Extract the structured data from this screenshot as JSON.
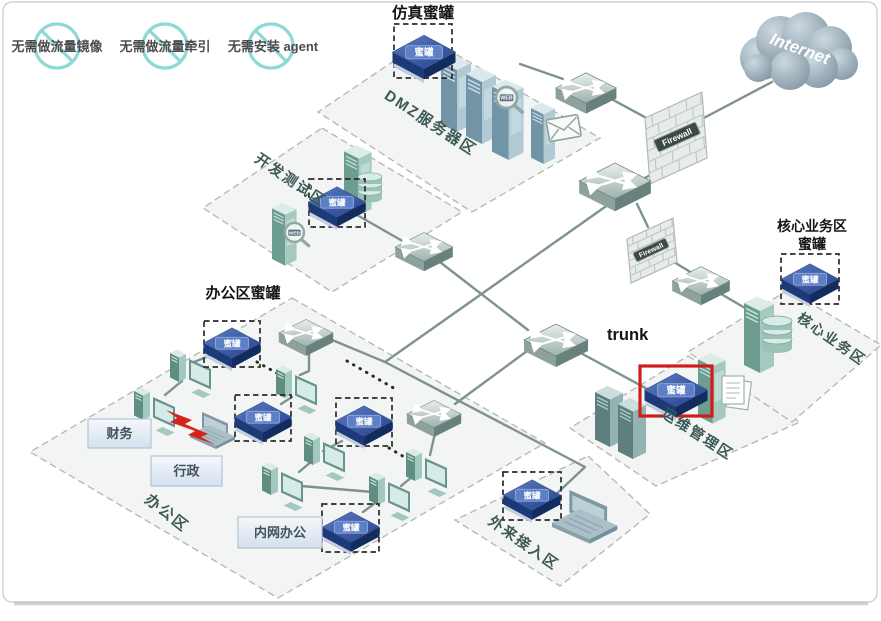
{
  "titles": {
    "simulation_honeypot": "仿真蜜罐",
    "office_honeypot": "办公区蜜罐",
    "core_honeypot_line1": "核心业务区",
    "core_honeypot_line2": "蜜罐",
    "trunk": "trunk",
    "internet": "Internet"
  },
  "restrictions": [
    "无需做流量镜像",
    "无需做流量牵引",
    "无需安装 agent"
  ],
  "zones": [
    {
      "id": "dmz",
      "label": "DMZ服务器区"
    },
    {
      "id": "dev",
      "label": "开发测试区"
    },
    {
      "id": "office",
      "label": "办公区"
    },
    {
      "id": "ops",
      "label": "运维管理区"
    },
    {
      "id": "core",
      "label": "核心业务区"
    },
    {
      "id": "external",
      "label": "外来接入区"
    }
  ],
  "office_groups": [
    "财务",
    "行政",
    "内网办公"
  ],
  "devices": {
    "honeypot_label": "蜜罐",
    "firewall_label": "Firewall",
    "web_label": "WEB"
  },
  "colors": {
    "trunk": "#e87c25",
    "honeypot_blue": "#2c4a8e",
    "highlight_red": "#cf1d1d",
    "link": "#7e938d",
    "restriction_circle": "#8ed8d6"
  }
}
